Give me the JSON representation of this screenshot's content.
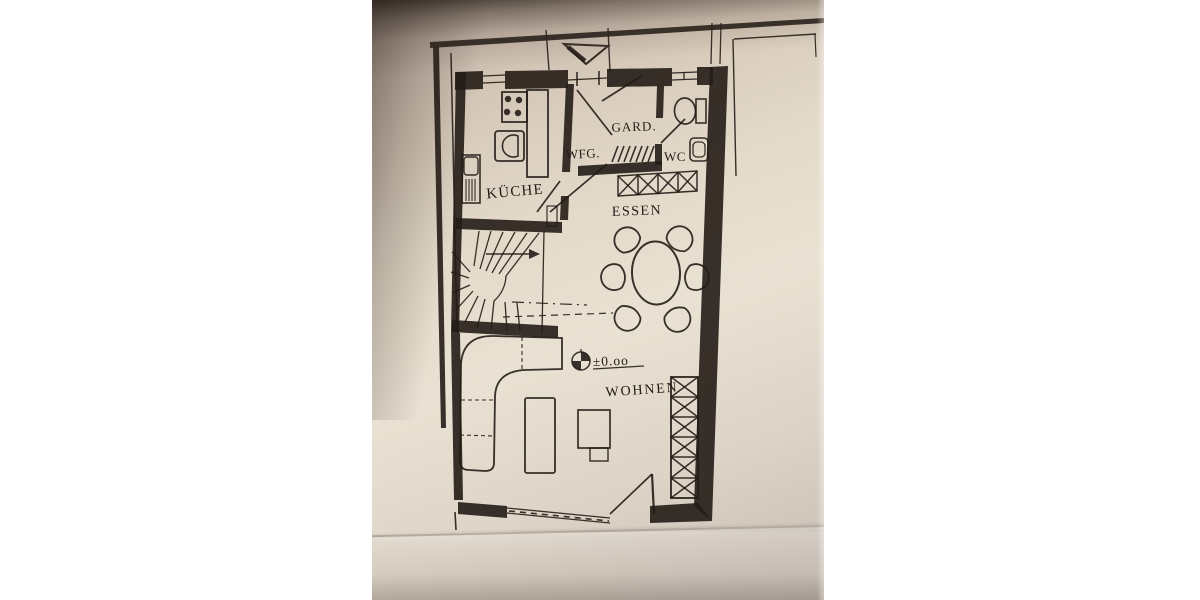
{
  "scene": {
    "type": "photographed architectural floor plan on paper",
    "language": "German",
    "paper_color": "#e9e1d2",
    "ink_color": "#241c16",
    "shadow_color": "#3a2c22",
    "page_background": "#ffffff"
  },
  "floor_plan": {
    "rooms": [
      {
        "id": "kueche",
        "label": "KÜCHE"
      },
      {
        "id": "windfang",
        "label": "WFG."
      },
      {
        "id": "garderobe",
        "label": "GARD."
      },
      {
        "id": "wc",
        "label": "WC"
      },
      {
        "id": "essen",
        "label": "ESSEN"
      },
      {
        "id": "wohnen",
        "label": "WOHNEN"
      }
    ],
    "level_marker": "±0.oo",
    "fixtures": [
      "entrance-arrow-triangle",
      "entrance-door",
      "coat-hatching",
      "wardrobe-x-row",
      "stove-4-burners",
      "kitchen-sink",
      "kitchen-counter",
      "tall-cabinet",
      "winder-staircase",
      "stair-direction-arrow",
      "toilet",
      "wash-basin",
      "dining-table-oval",
      "dining-chairs-x6",
      "benchmark-level-symbol",
      "corner-sofa",
      "coffee-table",
      "tv-table",
      "shelf-unit-x-column",
      "terrace-door",
      "living-room-window",
      "property-boundary-lines",
      "paper-crease"
    ]
  }
}
